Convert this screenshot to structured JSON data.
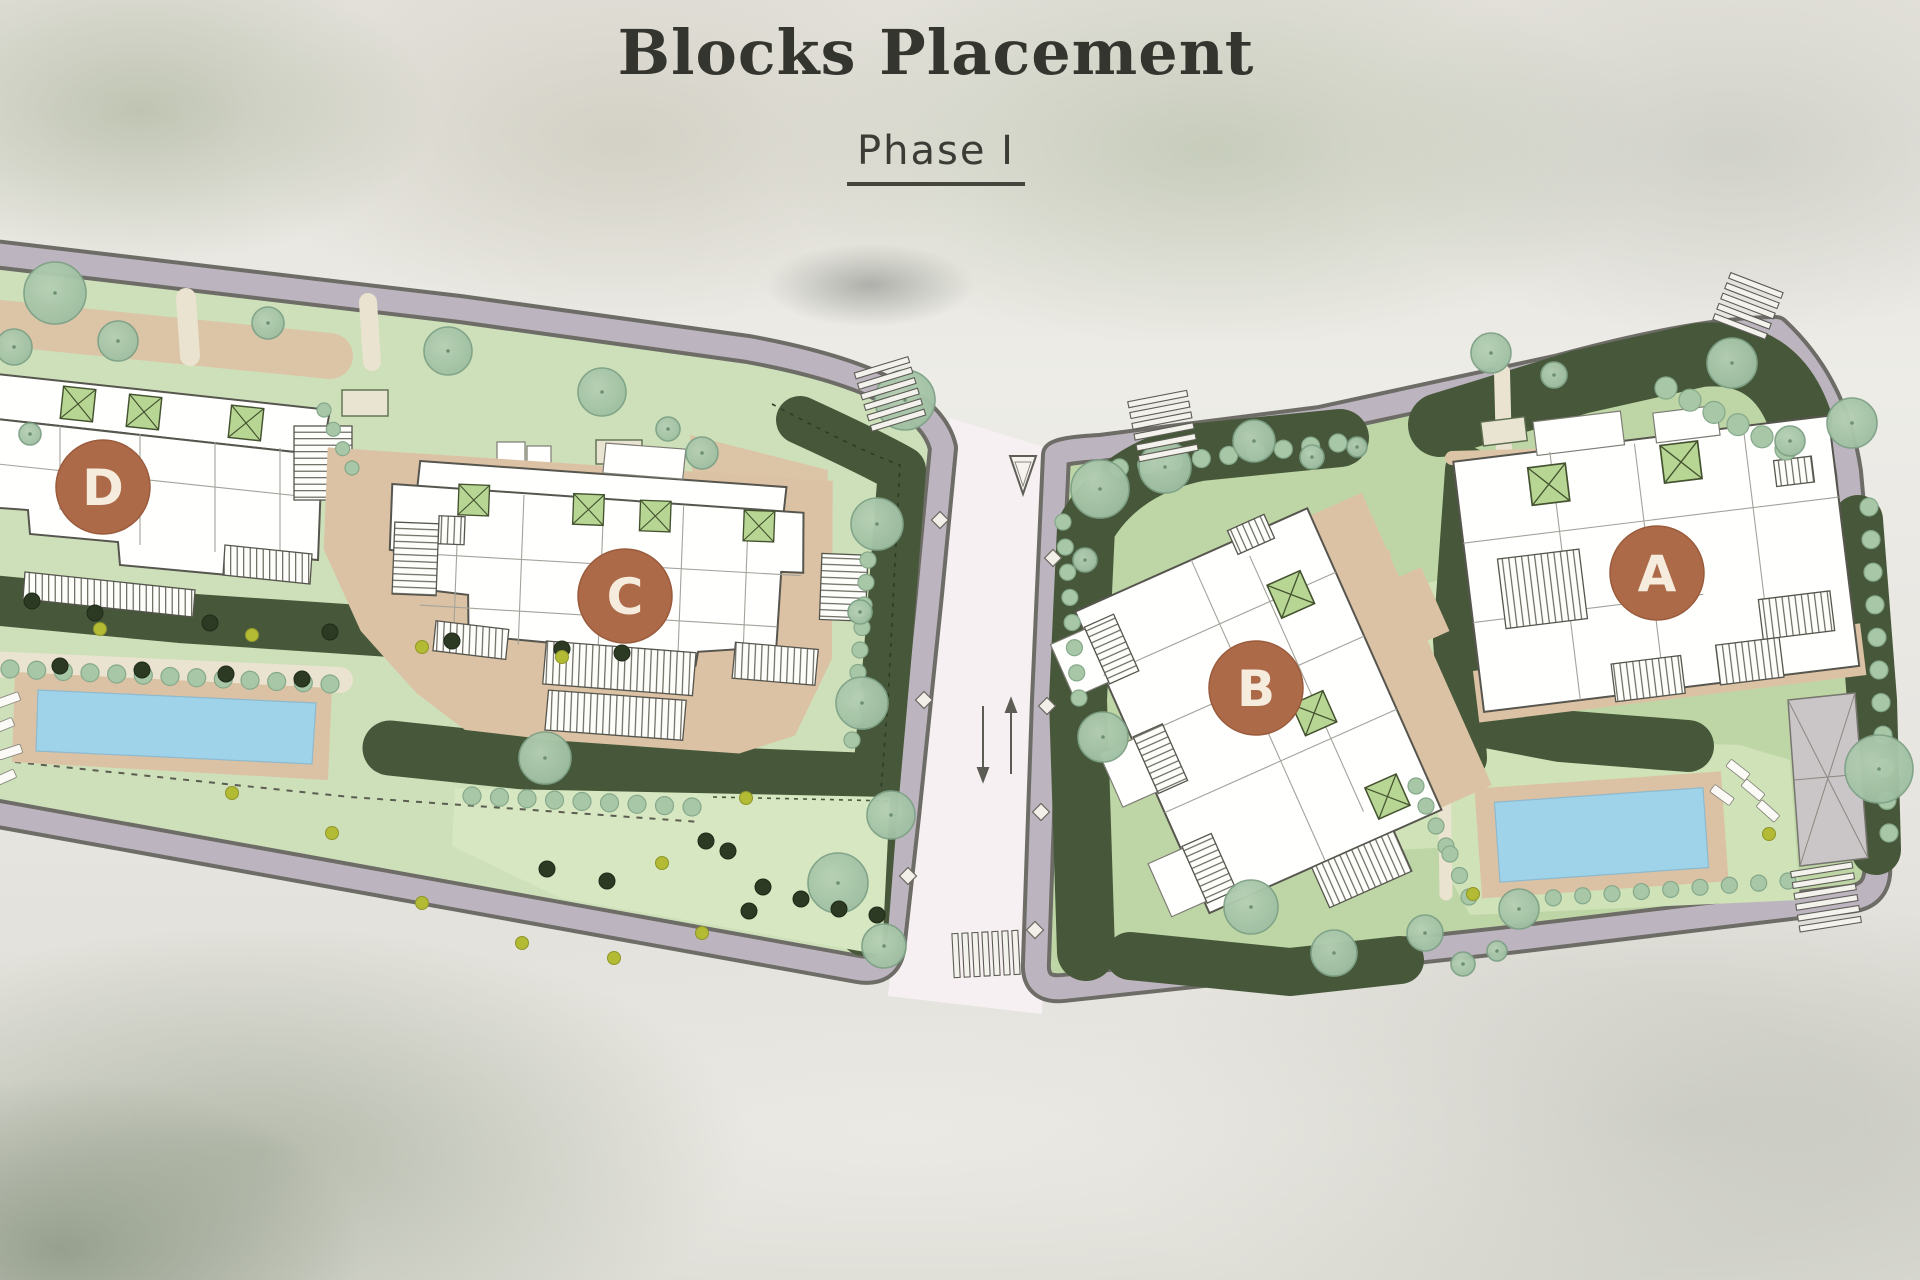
{
  "title": "Blocks Placement",
  "subtitle": "Phase I",
  "blocks": [
    {
      "label": "A"
    },
    {
      "label": "B"
    },
    {
      "label": "C"
    },
    {
      "label": "D"
    }
  ],
  "colors": {
    "badge": "#ac6a49",
    "badge_text": "#f6ecdd",
    "pool_water": "#9fd3ea",
    "lawn_light": "#cde0ba",
    "lawn_medium": "#bed6a6",
    "landscape_dark": "#47583a",
    "terrace_tan": "#dcc2a4",
    "sidewalk": "#bcb4be",
    "road_surface": "#f6f0f2",
    "building_fill": "#fffffe",
    "title_text": "#35352f"
  }
}
